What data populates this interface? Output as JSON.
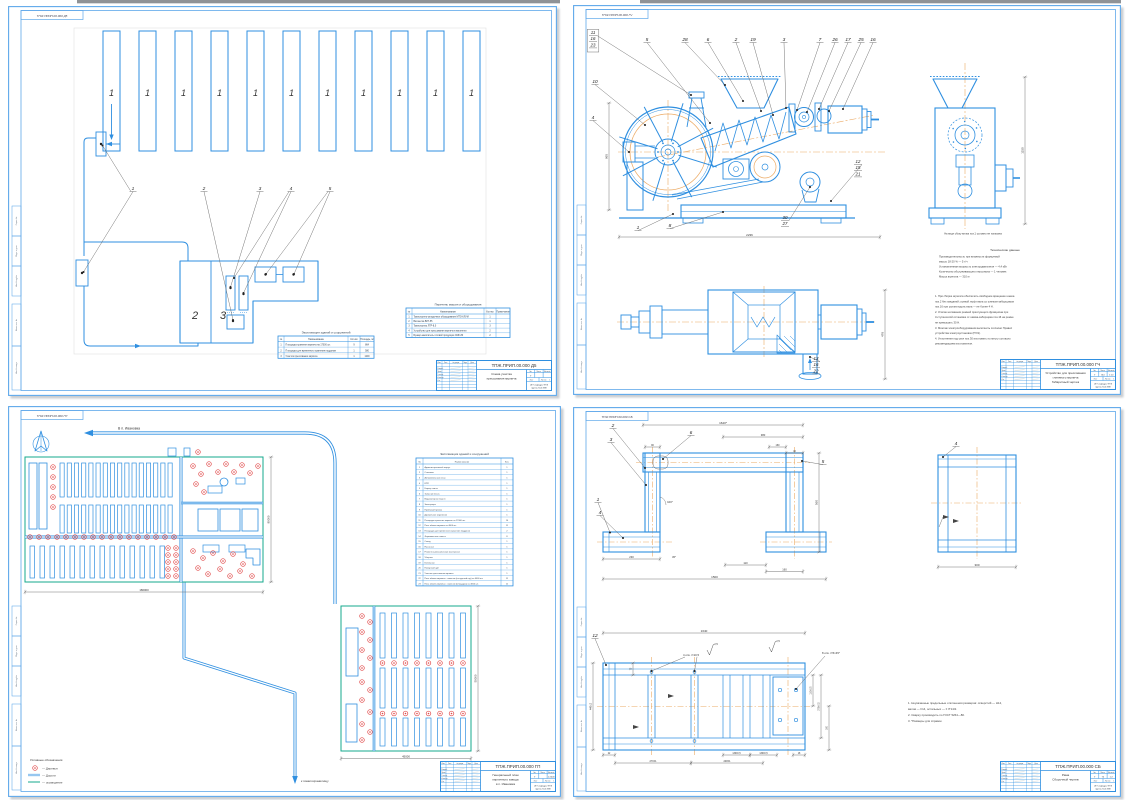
{
  "colors": {
    "blue": "#2f8fe0",
    "frame": "#5fa8ea",
    "orange": "#ecab66",
    "red": "#e04747",
    "green": "#16a98c",
    "ink": "#3a3f44"
  },
  "tb": {
    "head": [
      "Изм.",
      "Лист",
      "№ докум.",
      "Подп.",
      "Дата"
    ],
    "roles": [
      "Разраб.",
      "Пров.",
      "Т.контр.",
      "Н.контр.",
      "Утв."
    ],
    "lit": "Лит.",
    "mass": "Масса",
    "scale": "Масштаб",
    "sheet": "Лист",
    "sheets": "Листов",
    "lit_v": "У",
    "sheets_v": "1",
    "org1": "ЧГУ кафедра ТПЖ",
    "org2": "группа П-41 МЖ"
  },
  "side_labels": [
    "Справ. №",
    "Подп. и дата",
    "Инв. № дубл.",
    "Взам. инв. №",
    "Инв. № подл."
  ],
  "sheets": {
    "scheme": {
      "corner": "ТПЖ.ПРИП.00.000 Д5",
      "chamber": "1",
      "unit2": "2",
      "unit3": "3",
      "callouts": [
        "1",
        "2",
        "3",
        "4",
        "5"
      ],
      "explication": {
        "title": "Экспликация зданий и сооружений",
        "headers": [
          "№",
          "Наименование",
          "Кол-во",
          "Площадь, м²"
        ],
        "rows": [
          [
            "1",
            "Площадка хранения кирпича на 17000 шт.",
            "9",
            "864"
          ],
          [
            "2",
            "Площадка для временного хранения поддонов",
            "1",
            "580"
          ],
          [
            "3",
            "Участок прессования кирпича",
            "1",
            "1200"
          ]
        ]
      },
      "equipment": {
        "title": "Перечень машин и оборудования",
        "headers": [
          "№",
          "Наименование",
          "Кол-во",
          "Примечание"
        ],
        "rows": [
          [
            "1",
            "Транспортно-укладочное оборудование МТО-КЛУМ",
            "1",
            ""
          ],
          [
            "2",
            "Вагонетка ВЛГ-55",
            "1",
            ""
          ],
          [
            "3",
            "Транспортер ЛТР-8,0",
            "3",
            ""
          ],
          [
            "4",
            "Устройство для прессования кирпича в вагонетки",
            "2",
            ""
          ],
          [
            "5",
            "Бункер-накопитель готовой продукции СМК-80",
            "2",
            ""
          ]
        ]
      },
      "tb": {
        "code": "ТПЖ.ПРИП.00.000 Д5",
        "t1": "Схема участка",
        "t2": "прессования кирпича",
        "t3": "",
        "scale": "",
        "mass": ""
      }
    },
    "machine": {
      "corner": "ТПЖ.ПРИП.00.000 ГЧ",
      "stack_top": [
        "11",
        "16",
        "23"
      ],
      "top": [
        "5",
        "28",
        "6",
        "2",
        "19",
        "3",
        "7",
        "26",
        "17",
        "25",
        "16"
      ],
      "left": [
        "10",
        "4"
      ],
      "bottom": [
        "1",
        "8"
      ],
      "stack_bottom": [
        "30",
        "27"
      ],
      "stack_right": [
        "12",
        "15",
        "21"
      ],
      "stack_plan": [
        "13",
        "16",
        "22"
      ],
      "dim_len": "2236",
      "dim_h": "965",
      "dim_side": "1150",
      "dim_plan": "478",
      "side_note": "На виде сбоку вилка поз.1 условно не показана",
      "tech_title": "Технические данные",
      "tech": [
        "Производительность при влажности формуемой",
        "массы 18-20 % — 5 т/ч",
        "Установленная мощность электродвигателя — 4,4 кВт",
        "Количество обслуживающего персонала — 1 человек",
        "Масса агрегата — 310 кг"
      ],
      "notes": [
        "1. При сборке агрегата обеспечить свободное вращение шнека",
        "поз.2 без заеданий; осевой люфт вала со шнеком-заборщиком",
        "поз.16 при усилии вдоль вала — не более 4 Н.",
        "2. Усилие натяжения ремней прессующего фрикциона при",
        "3-ступенчатой остановке от шкива-заборщика поз.16 на ремне",
        "не превышать 30 Н.",
        "3. Монтаж электрооборудования выполнить согласно Правил",
        "устройства электроустановок (ПУЭ).",
        "4. Уплотнения под узел поз.30 изготовить по месту согласно",
        "рекомендациям изготовителя."
      ],
      "tb": {
        "code": "ТПЖ.ПРИП.00.000 ГЧ",
        "t1": "Устройство для прессования",
        "t2": "глиняного кирпича",
        "t3": "Габаритный чертеж",
        "scale": "1:10",
        "mass": "310"
      }
    },
    "genplan": {
      "corner": "ТПЖ.ПРИП.00.000 ГП",
      "road_in": "В п. Ивановка",
      "road_out": "к пометохранилищу",
      "d_main_w": "180000",
      "d_main_h": "80000",
      "d_sec_w": "45000",
      "d_sec_h": "50000",
      "legend": {
        "title": "Условные обозначения",
        "tree": "— Деревья",
        "road": "— Дороги",
        "fence": "— ограждение"
      },
      "explication": {
        "title": "Экспликация зданий и сооружений",
        "headers": [
          "№",
          "Наименование",
          "Кол."
        ],
        "rows": [
          [
            "1",
            "Административный корпус",
            "1"
          ],
          [
            "2",
            "Столовая",
            "1"
          ],
          [
            "3",
            "Автомобильные весы",
            "1"
          ],
          [
            "4",
            "КПП",
            "1"
          ],
          [
            "5",
            "Карьер глины",
            "1"
          ],
          [
            "6",
            "Запасник песка",
            "1"
          ],
          [
            "7",
            "Водонапорная башня",
            "1"
          ],
          [
            "8",
            "Электроцех",
            "1"
          ],
          [
            "9",
            "Приёмный бункер",
            "1"
          ],
          [
            "10",
            "Дробильное отделение",
            "1"
          ],
          [
            "11",
            "Площадка хранения кирпича на 17000 шт.",
            "14"
          ],
          [
            "12",
            "Печь обжига кирпича на 4000 шт.",
            "11"
          ],
          [
            "13",
            "Площадка для временного хранения поддонов",
            "2"
          ],
          [
            "14",
            "Формовочные навесы",
            "8"
          ],
          [
            "15",
            "Склад",
            "1"
          ],
          [
            "16",
            "Насосная",
            "1"
          ],
          [
            "17",
            "Ремонтно-механическая мастерская",
            "1"
          ],
          [
            "18",
            "Уборная",
            "1"
          ],
          [
            "19",
            "Котельная",
            "1"
          ],
          [
            "20",
            "Пожарный щит",
            "1"
          ],
          [
            "21",
            "Участок прессования кирпича",
            "1"
          ],
          [
            "22",
            "Печь обжига кирпича с навесом (на круглый год) на 4000 шт.",
            "11"
          ],
          [
            "23",
            "Печь обжига кирпича с навесом (площадка) на 4000 шт.",
            "11"
          ]
        ]
      },
      "tb": {
        "code": "ТПЖ.ПРИП.00.000 ГП",
        "t1": "Генеральный план",
        "t2": "кирпичного завода",
        "t3": "в п. Ивановка",
        "scale": "1:2000",
        "mass": ""
      }
    },
    "frame": {
      "corner": "ТПЖ.ПРИП.00.000 СБ",
      "callouts": {
        "c2": "2",
        "c3": "3",
        "c6": "6",
        "c5": "5",
        "c1": "1",
        "c4": "4",
        "side": "4",
        "plan": "12"
      },
      "dims": {
        "top": "1640*",
        "seg": "380",
        "s160": "160",
        "s40": "40",
        "s90": "90",
        "a100": "100°",
        "h560": "560",
        "f230": "230",
        "a45": "45°",
        "b110": "110",
        "b160": "160",
        "w1500": "1500",
        "side300": "300",
        "p1640": "1640",
        "p75": "75",
        "p22": "22",
        "p270": "270±1",
        "p248": "248±1",
        "p130a": "130±0,5",
        "p130b": "130±0,5",
        "p18": "18",
        "v110": "110±0,5",
        "v270": "270±0,5",
        "v160": "160",
        "v440": "440±2",
        "holes4": "4 отв. ∅10,5",
        "holes8": "8 отв. ∅5×45°",
        "rough1": "2,5",
        "rough2": "2,5"
      },
      "notes": [
        "1. Неуказанные предельные отклонения размеров: отверстий — Н14,",
        "валов — h14, остальных — ± IT14/2.",
        "2. Сварку производить по ГОСТ 5264—80.",
        "3. *Размеры для справок."
      ],
      "tb": {
        "code": "ТПЖ.ПРИП.00.000 СБ",
        "t1": "Рама",
        "t2": "Сборочный чертеж",
        "t3": "",
        "scale": "1:2",
        "mass": "74"
      }
    }
  }
}
